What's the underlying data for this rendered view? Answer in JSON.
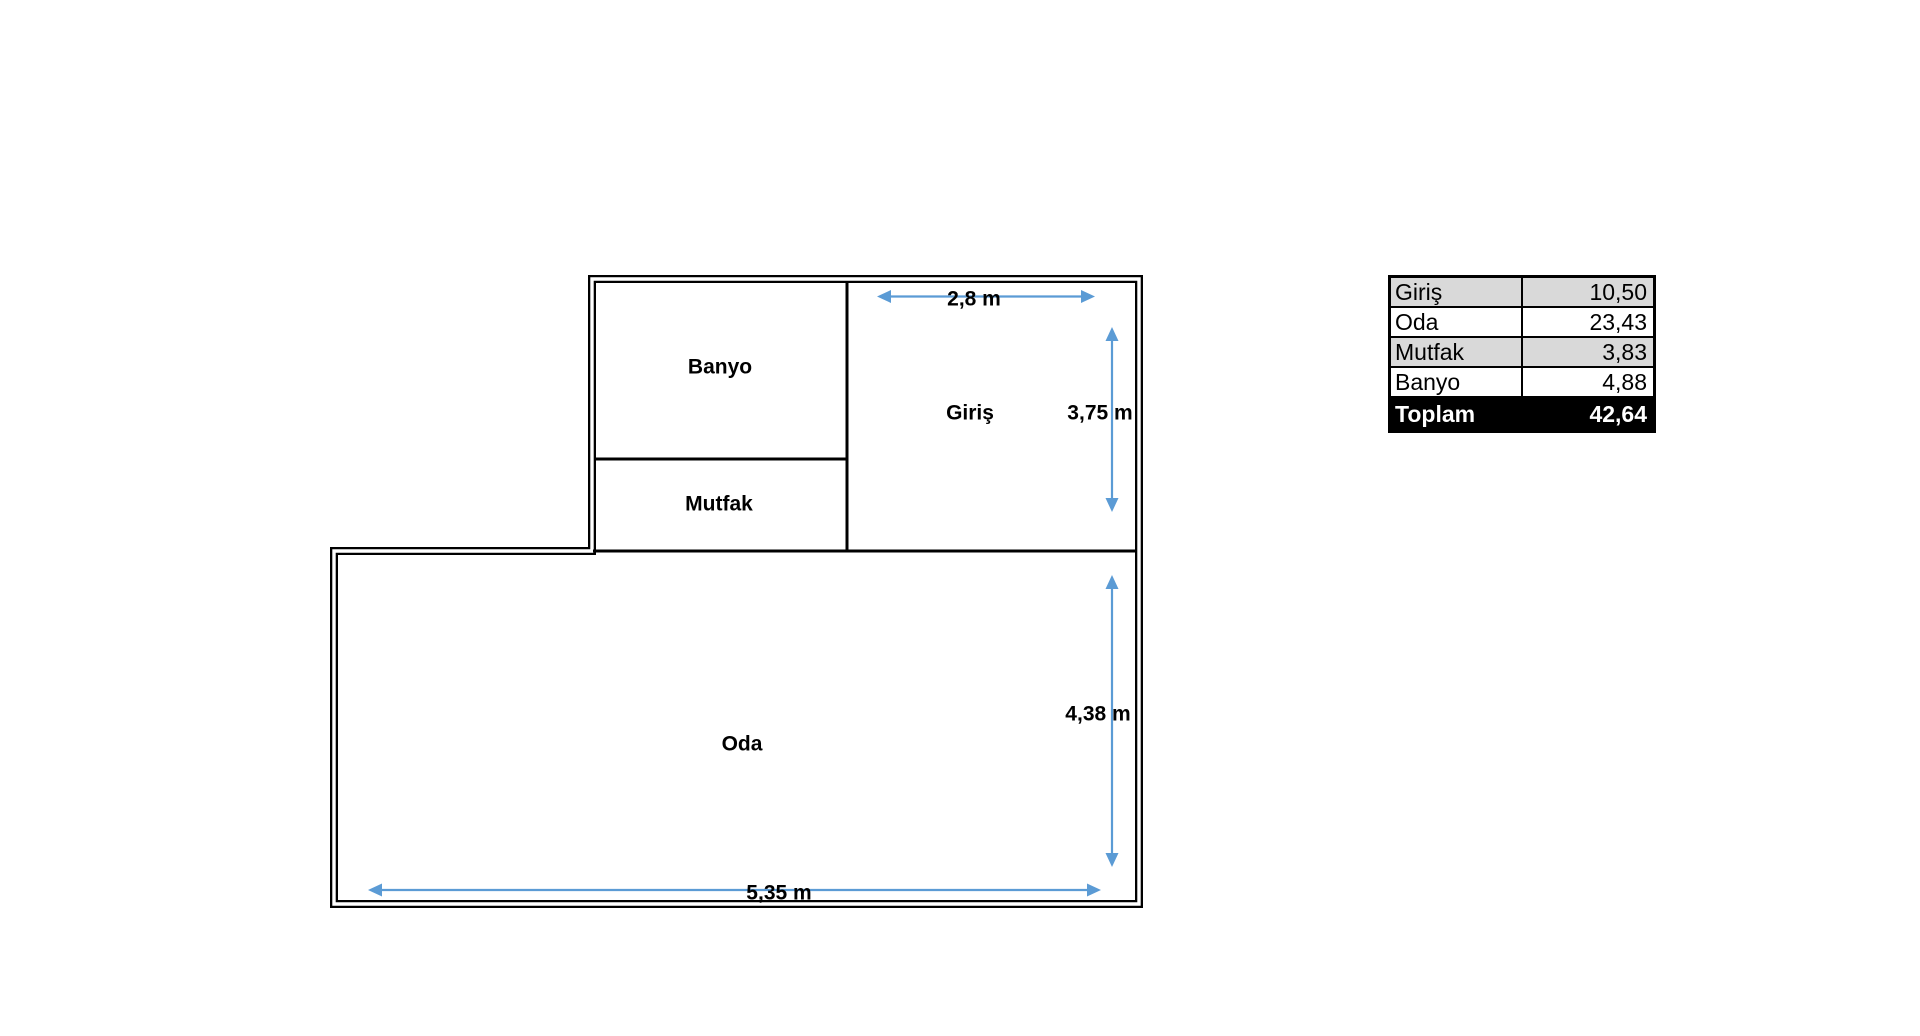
{
  "floor_plan": {
    "rooms": [
      {
        "id": "banyo",
        "label": "Banyo"
      },
      {
        "id": "mutfak",
        "label": "Mutfak"
      },
      {
        "id": "giris",
        "label": "Giriş"
      },
      {
        "id": "oda",
        "label": "Oda"
      }
    ],
    "dimensions": [
      {
        "id": "giris-width",
        "label": "2,8 m",
        "orientation": "horizontal"
      },
      {
        "id": "giris-height",
        "label": "3,75 m",
        "orientation": "vertical"
      },
      {
        "id": "oda-height",
        "label": "4,38 m",
        "orientation": "vertical"
      },
      {
        "id": "oda-width",
        "label": "5,35 m",
        "orientation": "horizontal"
      }
    ],
    "colors": {
      "wall": "#000000",
      "dimension_arrow": "#5B9BD5",
      "room_fill": "#FFFFFF"
    }
  },
  "area_table": {
    "rows": [
      {
        "label": "Giriş",
        "value": "10,50"
      },
      {
        "label": "Oda",
        "value": "23,43"
      },
      {
        "label": "Mutfak",
        "value": "3,83"
      },
      {
        "label": "Banyo",
        "value": "4,88"
      }
    ],
    "total": {
      "label": "Toplam",
      "value": "42,64"
    },
    "colors": {
      "shaded_row": "#D9D9D9",
      "plain_row": "#FFFFFF",
      "total_bg": "#000000",
      "total_fg": "#FFFFFF",
      "border": "#000000"
    }
  }
}
